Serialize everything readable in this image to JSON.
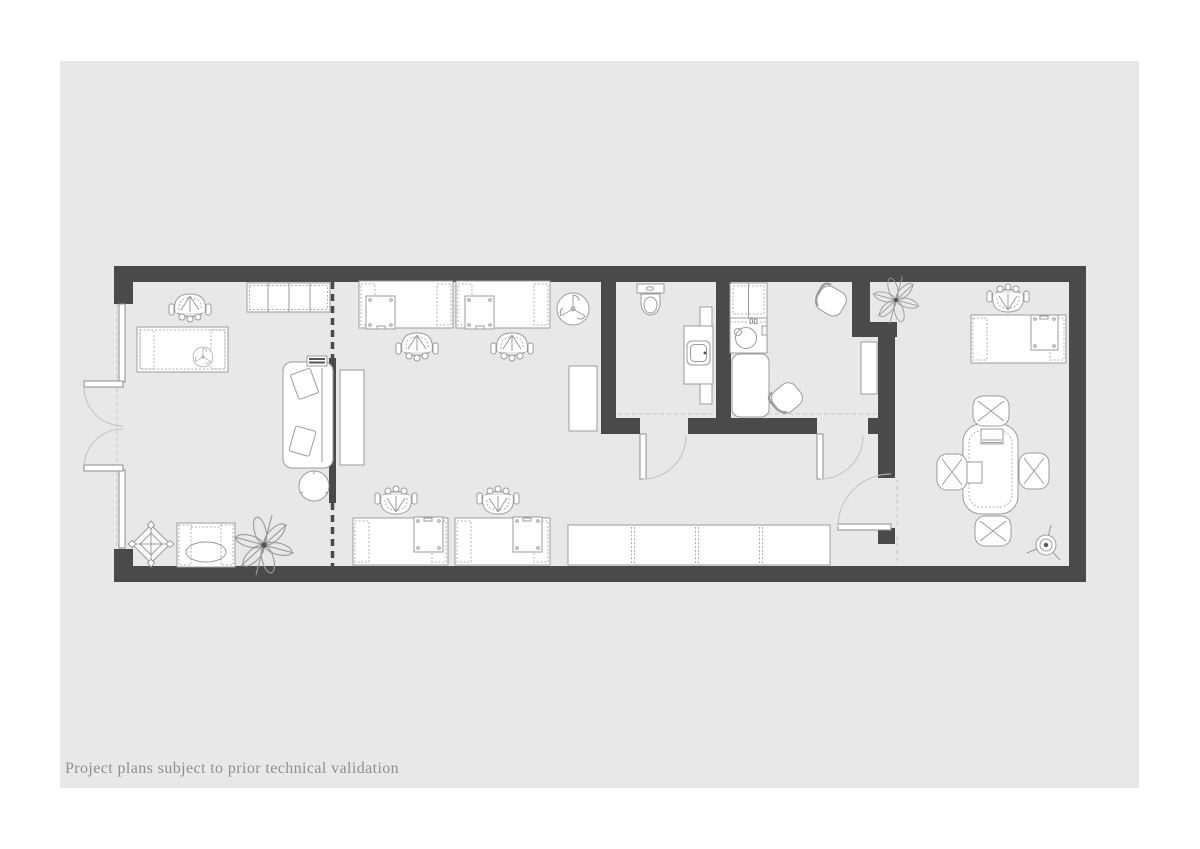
{
  "page": {
    "background_color": "#ffffff",
    "sheet_color": "#e8e8e8",
    "caption": "Project plans subject to prior technical validation",
    "caption_color": "#8f8f8f"
  },
  "plan": {
    "type": "architectural floor plan, top view",
    "wall_color": "#4a4a4a",
    "furniture_line_color": "#9b9b9b",
    "rooms": [
      {
        "name": "lounge-reception",
        "furniture": [
          "desk with office chair",
          "desk fan",
          "shelving unit",
          "sofa with two cushions",
          "media console",
          "round coffee table",
          "armchair",
          "large plant",
          "diamond ornament"
        ]
      },
      {
        "name": "open-plan-office",
        "furniture": [
          "four workstation desks with drawer units",
          "four task chairs",
          "pedestal fan",
          "long sideboard",
          "tall cabinet"
        ]
      },
      {
        "name": "wc",
        "furniture": [
          "toilet",
          "washbasin vanity"
        ]
      },
      {
        "name": "kitchenette",
        "furniture": [
          "counter with sink",
          "kitchen table",
          "two kitchen chairs",
          "wall cabinet"
        ]
      },
      {
        "name": "meeting-office",
        "furniture": [
          "desk with task chair and drawer unit",
          "meeting table",
          "four meeting chairs",
          "floor lamp",
          "plant"
        ]
      }
    ],
    "openings": [
      "double entrance doors on left facade",
      "wc door",
      "kitchenette door",
      "meeting office door"
    ],
    "partition": "dashed partition line with solid screen behind sofa"
  }
}
